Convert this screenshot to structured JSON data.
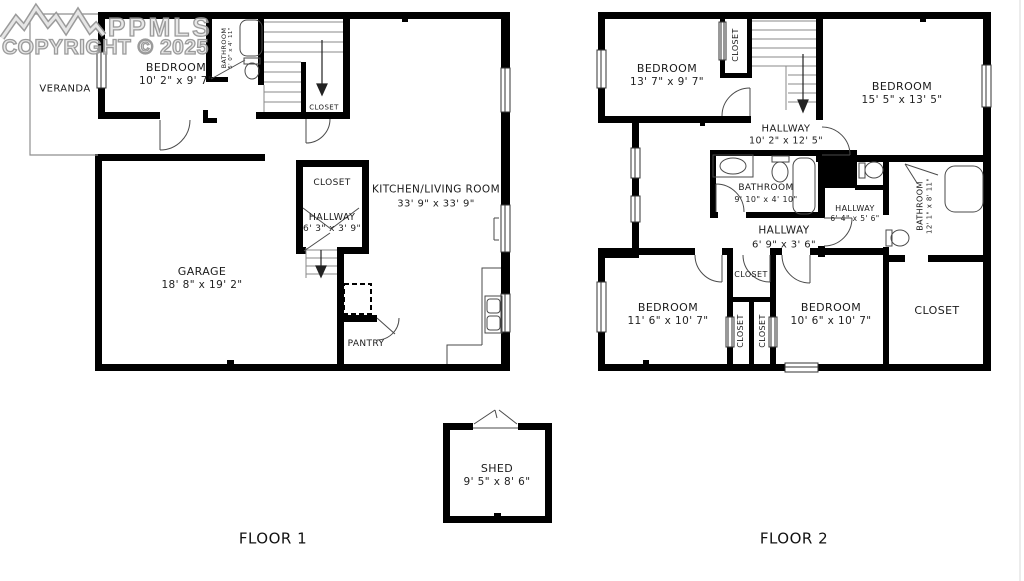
{
  "watermark": {
    "brand": "PPMLS",
    "copyright": "COPYRIGHT © 2025"
  },
  "floor1": {
    "label": "FLOOR 1",
    "rooms": {
      "veranda": {
        "name": "VERANDA",
        "dims": ""
      },
      "bedroom": {
        "name": "BEDROOM",
        "dims": "10' 2\" x 9' 7\""
      },
      "bathroom": {
        "name": "BATHROOM",
        "dims": "5' 0\" x 4' 11\""
      },
      "stair_closet": {
        "name": "CLOSET",
        "dims": ""
      },
      "kitchen": {
        "name": "KITCHEN/LIVING ROOM",
        "dims": "33' 9\" x 33' 9\""
      },
      "hall_closet": {
        "name": "CLOSET",
        "dims": ""
      },
      "hallway": {
        "name": "HALLWAY",
        "dims": "6' 3\" x 3' 9\""
      },
      "garage": {
        "name": "GARAGE",
        "dims": "18' 8\" x 19' 2\""
      },
      "pantry": {
        "name": "PANTRY",
        "dims": ""
      }
    }
  },
  "floor2": {
    "label": "FLOOR 2",
    "rooms": {
      "bedroom_tl": {
        "name": "BEDROOM",
        "dims": "13' 7\" x 9' 7\""
      },
      "closet_top": {
        "name": "CLOSET",
        "dims": ""
      },
      "bedroom_tr": {
        "name": "BEDROOM",
        "dims": "15' 5\" x 13' 5\""
      },
      "hallway_main": {
        "name": "HALLWAY",
        "dims": "10' 2\" x 12' 5\""
      },
      "bathroom_mid": {
        "name": "BATHROOM",
        "dims": "9' 10\" x 4' 10\""
      },
      "hallway_small": {
        "name": "HALLWAY",
        "dims": "6' 4\" x 5' 6\""
      },
      "hallway_lower": {
        "name": "HALLWAY",
        "dims": "6' 9\" x 3' 6\""
      },
      "bathroom_right": {
        "name": "BATHROOM",
        "dims": "12' 1\" x 8' 11\""
      },
      "bedroom_bl": {
        "name": "BEDROOM",
        "dims": "11' 6\" x 10' 7\""
      },
      "closet_small": {
        "name": "CLOSET",
        "dims": ""
      },
      "closet_v1": {
        "name": "CLOSET",
        "dims": ""
      },
      "closet_v2": {
        "name": "CLOSET",
        "dims": ""
      },
      "bedroom_br": {
        "name": "BEDROOM",
        "dims": "10' 6\" x 10' 7\""
      },
      "closet_walkin": {
        "name": "CLOSET",
        "dims": ""
      }
    }
  },
  "shed": {
    "name": "SHED",
    "dims": "9' 5\" x 8' 6\""
  }
}
